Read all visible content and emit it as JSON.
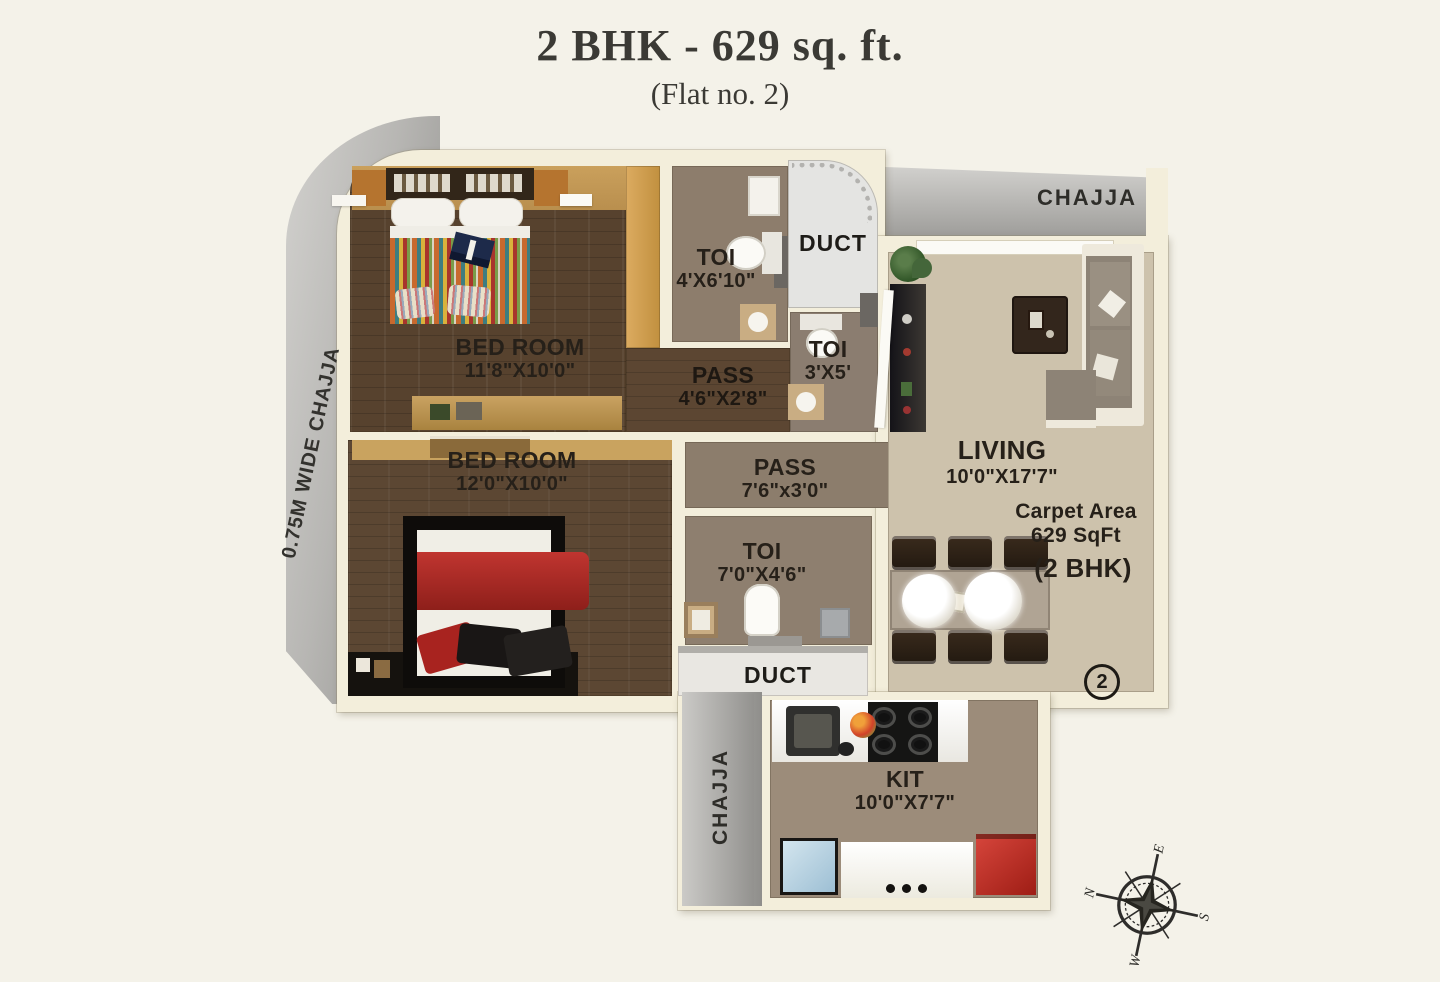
{
  "page": {
    "title": "2 BHK - 629 sq. ft.",
    "subtitle": "(Flat no. 2)"
  },
  "rooms": {
    "bedroom1": {
      "name": "BED ROOM",
      "dims": "11'8\"X10'0\""
    },
    "bedroom2": {
      "name": "BED ROOM",
      "dims": "12'0\"X10'0\""
    },
    "toilet1": {
      "name": "TOI",
      "dims": "4'X6'10\""
    },
    "toilet2": {
      "name": "TOI",
      "dims": "3'X5'"
    },
    "toilet3": {
      "name": "TOI",
      "dims": "7'0\"X4'6\""
    },
    "passage1": {
      "name": "PASS",
      "dims": "4'6\"X2'8\""
    },
    "passage2": {
      "name": "PASS",
      "dims": "7'6\"x3'0\""
    },
    "living": {
      "name": "LIVING",
      "dims": "10'0\"X17'7\""
    },
    "kitchen": {
      "name": "KIT",
      "dims": "10'0\"X7'7\""
    },
    "duct_top": {
      "name": "DUCT"
    },
    "duct_bottom": {
      "name": "DUCT"
    }
  },
  "chajja": {
    "left_label": "0.75M WIDE CHAJJA",
    "top_right": "CHAJJA",
    "bottom_left": "CHAJJA"
  },
  "carpet_area": {
    "line1": "Carpet Area",
    "line2": "629 SqFt",
    "line3": "(2 BHK)"
  },
  "flat_number": "2",
  "compass": {
    "north": "N",
    "east": "E",
    "south": "S",
    "west": "W"
  },
  "colors": {
    "background": "#f4f2e9",
    "wall_cream": "#f3eedb",
    "wood_dark": "#57422e",
    "living_floor": "#cdc2ac",
    "kitchen_floor": "#9c8c7a",
    "toilet_floor": "#8d7d6c",
    "chajja_gray": "#a8a7a4",
    "accent_red": "#b52b27",
    "label_color": "#262019"
  }
}
